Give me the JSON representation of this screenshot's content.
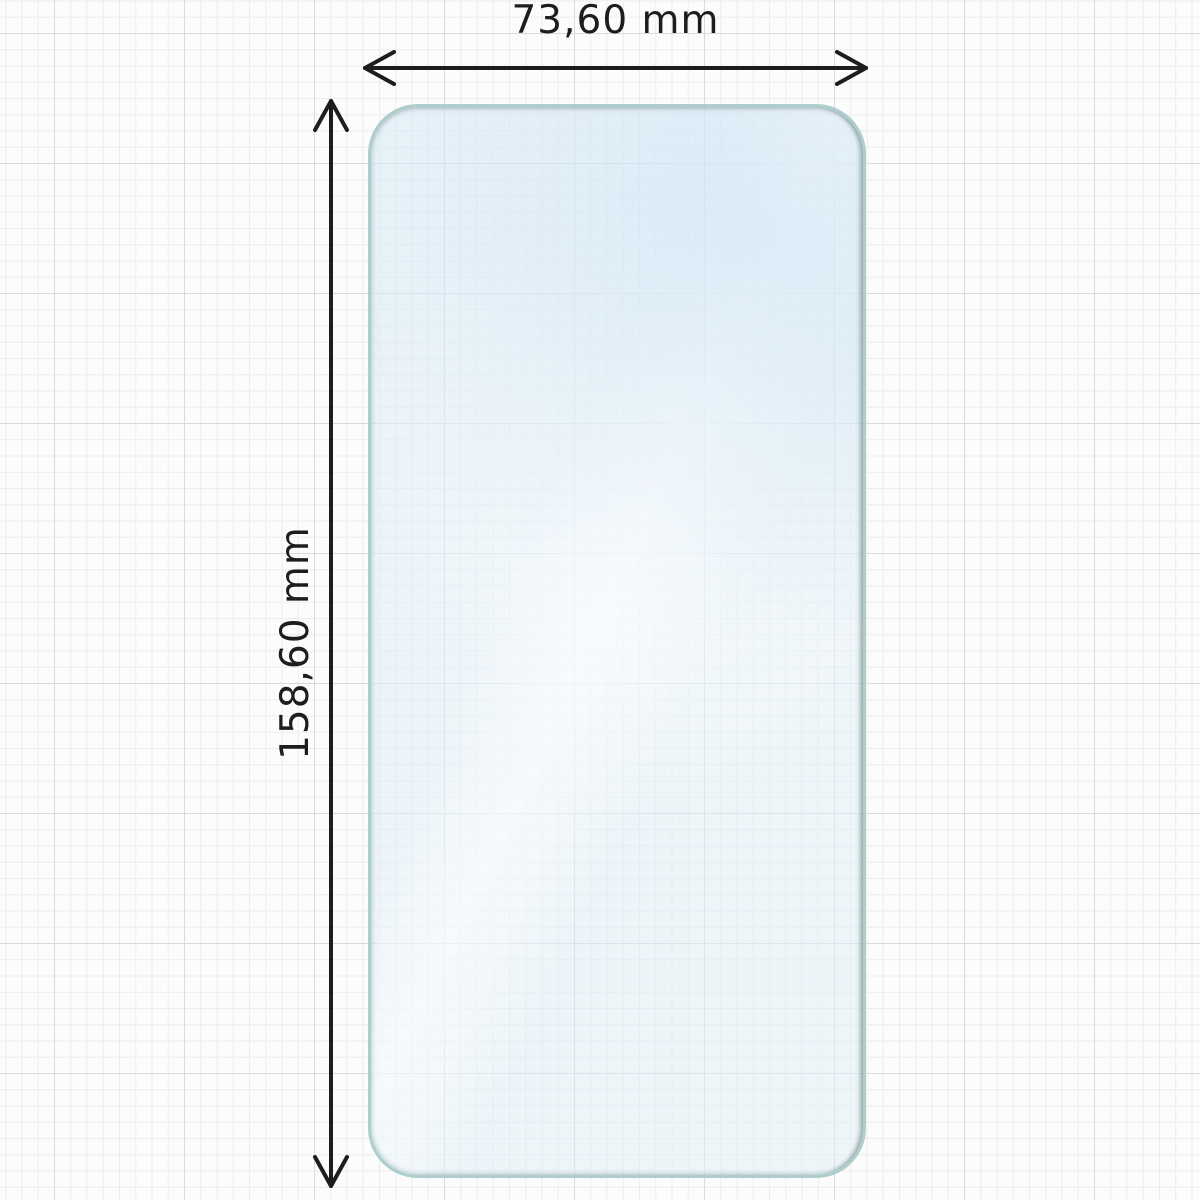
{
  "diagram": {
    "title": "screen-protector-dimension-diagram",
    "object": {
      "name": "screen protector film",
      "shape": "rounded-rectangle",
      "tint_color": "#dfeef6",
      "edge_color": "#aecdcd",
      "edge_dark_color": "#8ba19f"
    },
    "dimensions": {
      "width_label": "73,60 mm",
      "height_label": "158,60 mm"
    },
    "style": {
      "background_color": "#fcfcfc",
      "grid_minor_color": "#ebedee",
      "grid_major_color": "#d7dbde",
      "dimension_line_color": "#1d1d1d"
    }
  }
}
